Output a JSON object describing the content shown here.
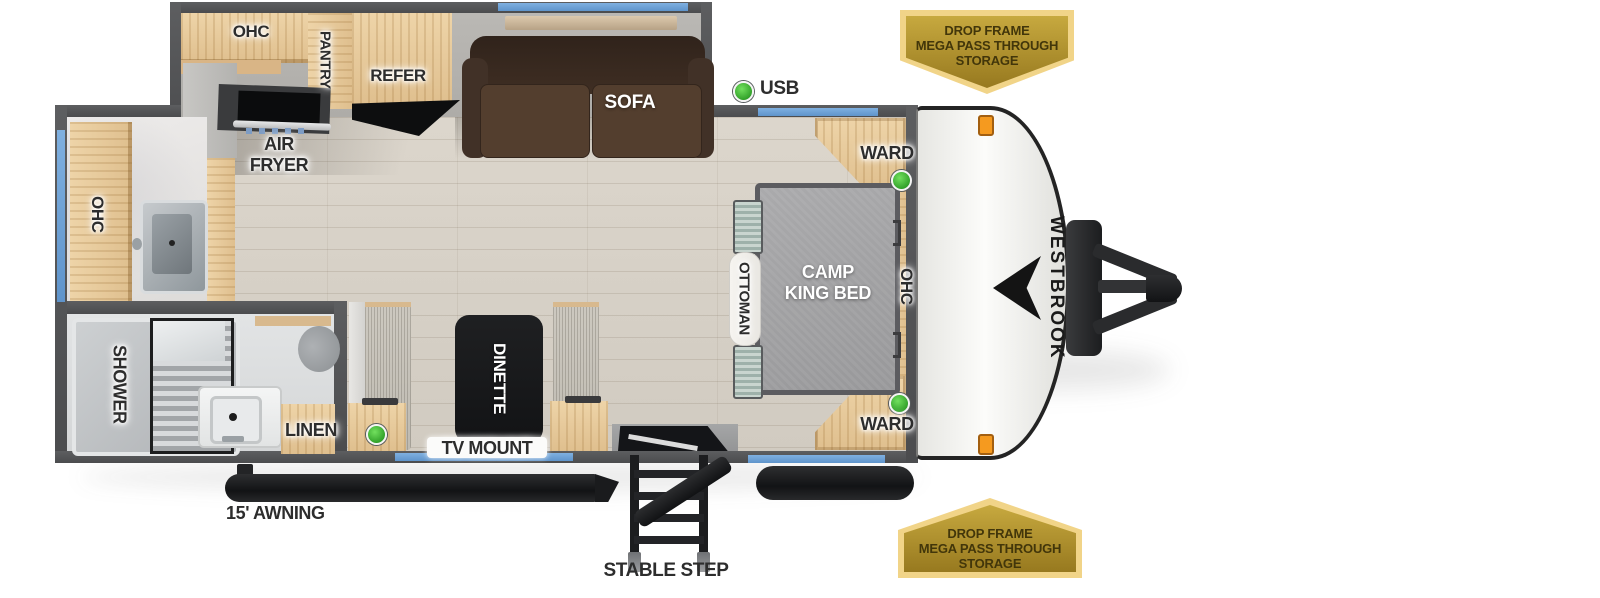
{
  "brand": {
    "logo_text": "WESTBROOK"
  },
  "badge_top": {
    "line1": "DROP FRAME",
    "line2": "MEGA PASS THROUGH",
    "line3": "STORAGE"
  },
  "badge_bottom": {
    "line1": "DROP FRAME",
    "line2": "MEGA PASS THROUGH",
    "line3": "STORAGE"
  },
  "labels": {
    "kitchen_ohc": "OHC",
    "pantry": "PANTRY",
    "refer": "REFER",
    "sofa": "SOFA",
    "usb": "USB",
    "air_fryer_line1": "AIR",
    "air_fryer_line2": "FRYER",
    "bath_ohc": "OHC",
    "ward_front": "WARD",
    "ward_rear": "WARD",
    "bed_line1": "CAMP",
    "bed_line2": "KING BED",
    "ottoman": "OTTOMAN",
    "bed_ohc": "OHC",
    "shower": "SHOWER",
    "linen": "LINEN",
    "dinette": "DINETTE",
    "tv_mount": "TV MOUNT",
    "awning": "15' AWNING",
    "stable_step": "STABLE STEP"
  },
  "indicators": {
    "usb_led": "green",
    "ward_front_led": "green",
    "ward_rear_led": "green",
    "dinette_led": "green"
  },
  "colors": {
    "badge_gold": "#c0a23a",
    "led_green": "#3cc232",
    "window_blue": "#6fa3d8",
    "clearance_orange": "#f59a1f",
    "wall_gray": "#555658",
    "sofa_brown": "#4e3a2b",
    "bed_gray": "#a1a1a3"
  }
}
